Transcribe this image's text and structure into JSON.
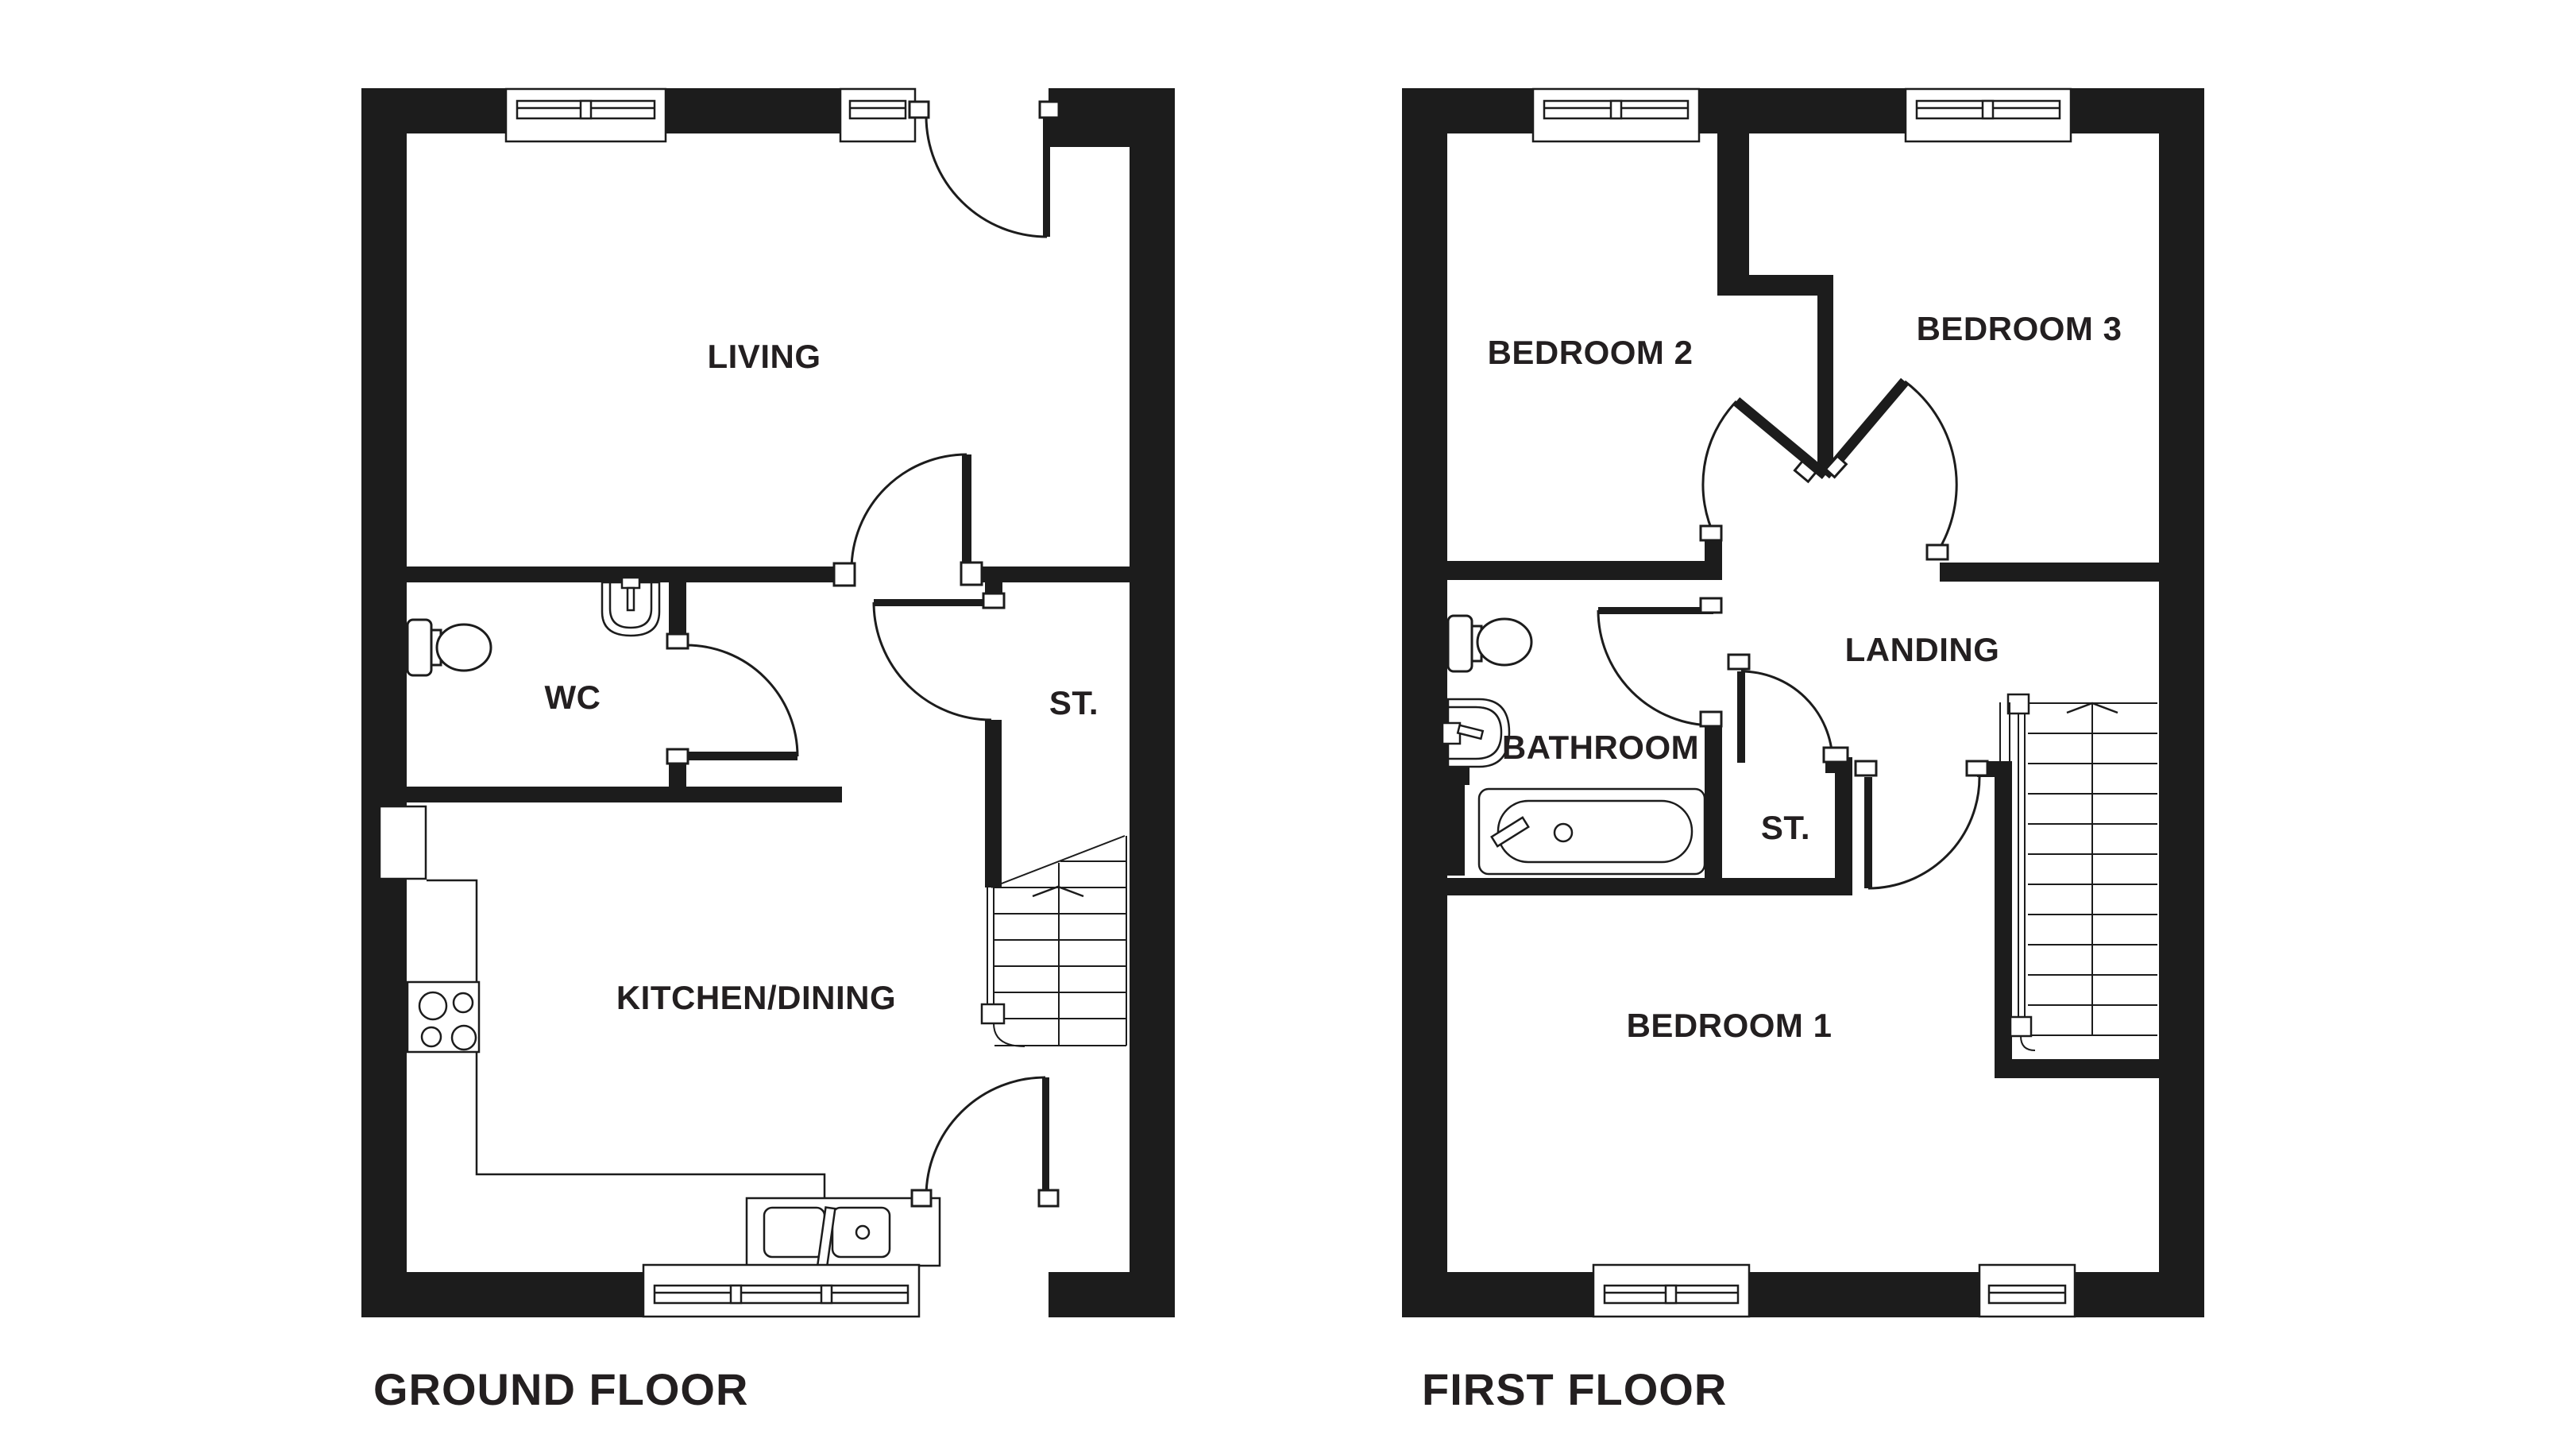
{
  "colors": {
    "background": "#ffffff",
    "wall": "#1c1c1c",
    "line": "#1c1c1c",
    "text": "#231f20"
  },
  "ground_floor": {
    "title": "GROUND FLOOR",
    "labels": {
      "living": "LIVING",
      "wc": "WC",
      "store": "ST.",
      "kitchen_dining": "KITCHEN/DINING"
    },
    "fixtures": [
      "toilet-icon",
      "hand-basin-icon",
      "hob-icon",
      "kitchen-sink-icon",
      "staircase-up-icon"
    ],
    "features": [
      "front-door",
      "living-door",
      "wc-door",
      "understairs-store-door",
      "back-door",
      "3-windows"
    ]
  },
  "first_floor": {
    "title": "FIRST FLOOR",
    "labels": {
      "bedroom2": "BEDROOM 2",
      "bedroom3": "BEDROOM 3",
      "landing": "LANDING",
      "bathroom": "BATHROOM",
      "store": "ST.",
      "bedroom1": "BEDROOM 1"
    },
    "fixtures": [
      "toilet-icon",
      "hand-basin-icon",
      "bathtub-icon",
      "staircase-up-icon"
    ],
    "features": [
      "bedroom2-door",
      "bedroom3-door",
      "bathroom-door",
      "store-door",
      "bedroom1-door",
      "4-windows"
    ]
  }
}
